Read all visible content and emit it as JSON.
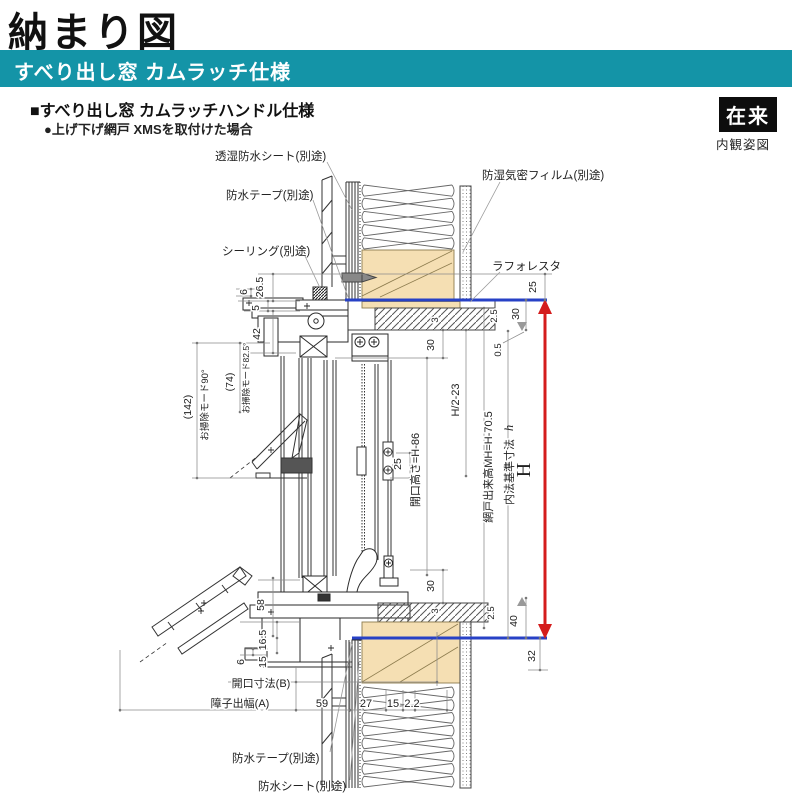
{
  "page": {
    "title": "納まり図",
    "band_title": "すべり出し窓 カムラッチ仕様",
    "spec_heading": "■すべり出し窓 カムラッチハンドル仕様",
    "spec_subheading": "●上げ下げ網戸 XMSを取付けた場合",
    "construction_badge": "在来",
    "view_caption": "内観姿図"
  },
  "colors": {
    "accent_teal": "#1494a7",
    "wood_fill": "#f5dfb3",
    "datum_blue": "#2741c6",
    "dimension_red": "#d41c1c"
  },
  "callouts": {
    "breathable_sheet": "透湿防水シート(別途)",
    "waterproof_tape_top": "防水テープ(別途)",
    "sealing": "シーリング(別途)",
    "vapor_film": "防湿気密フィルム(別途)",
    "laforesta": "ラフォレスタ",
    "waterproof_tape_bottom": "防水テープ(別途)",
    "waterproof_sheet_bottom": "防水シート(別途)"
  },
  "dims": {
    "tip6_top": "6",
    "d26_5": "26.5",
    "d5": "5",
    "d42": "42",
    "d142": "(142)",
    "clean90": "お掃除モード90°",
    "d74": "(74)",
    "clean82": "お掃除モード82.5°",
    "d3_top": "3",
    "d30_top": "30",
    "d25_mid": "25",
    "opening_height": "開口高さ=H-86",
    "half_h": "H/2-23",
    "d25_right": "25",
    "d2_5_tr": "2.5",
    "d30_tr": "30",
    "d0_5": "0.5",
    "screen_height": "網戸出来高MH=H-70.5",
    "inner_std": "内法基準寸法",
    "inner_std_h": "h",
    "big_h": "H",
    "d30_bot": "30",
    "d3_bot": "3",
    "d2_5_br": "2.5",
    "d40": "40",
    "d32": "32",
    "d58": "58",
    "d16_5": "16.5",
    "d15_left": "15",
    "tip6_bot": "6",
    "opening_b": "開口寸法(B)",
    "sash_a": "障子出幅(A)",
    "d59": "59",
    "d27": "27",
    "d15_bot": "15",
    "d2_2": "2.2"
  }
}
